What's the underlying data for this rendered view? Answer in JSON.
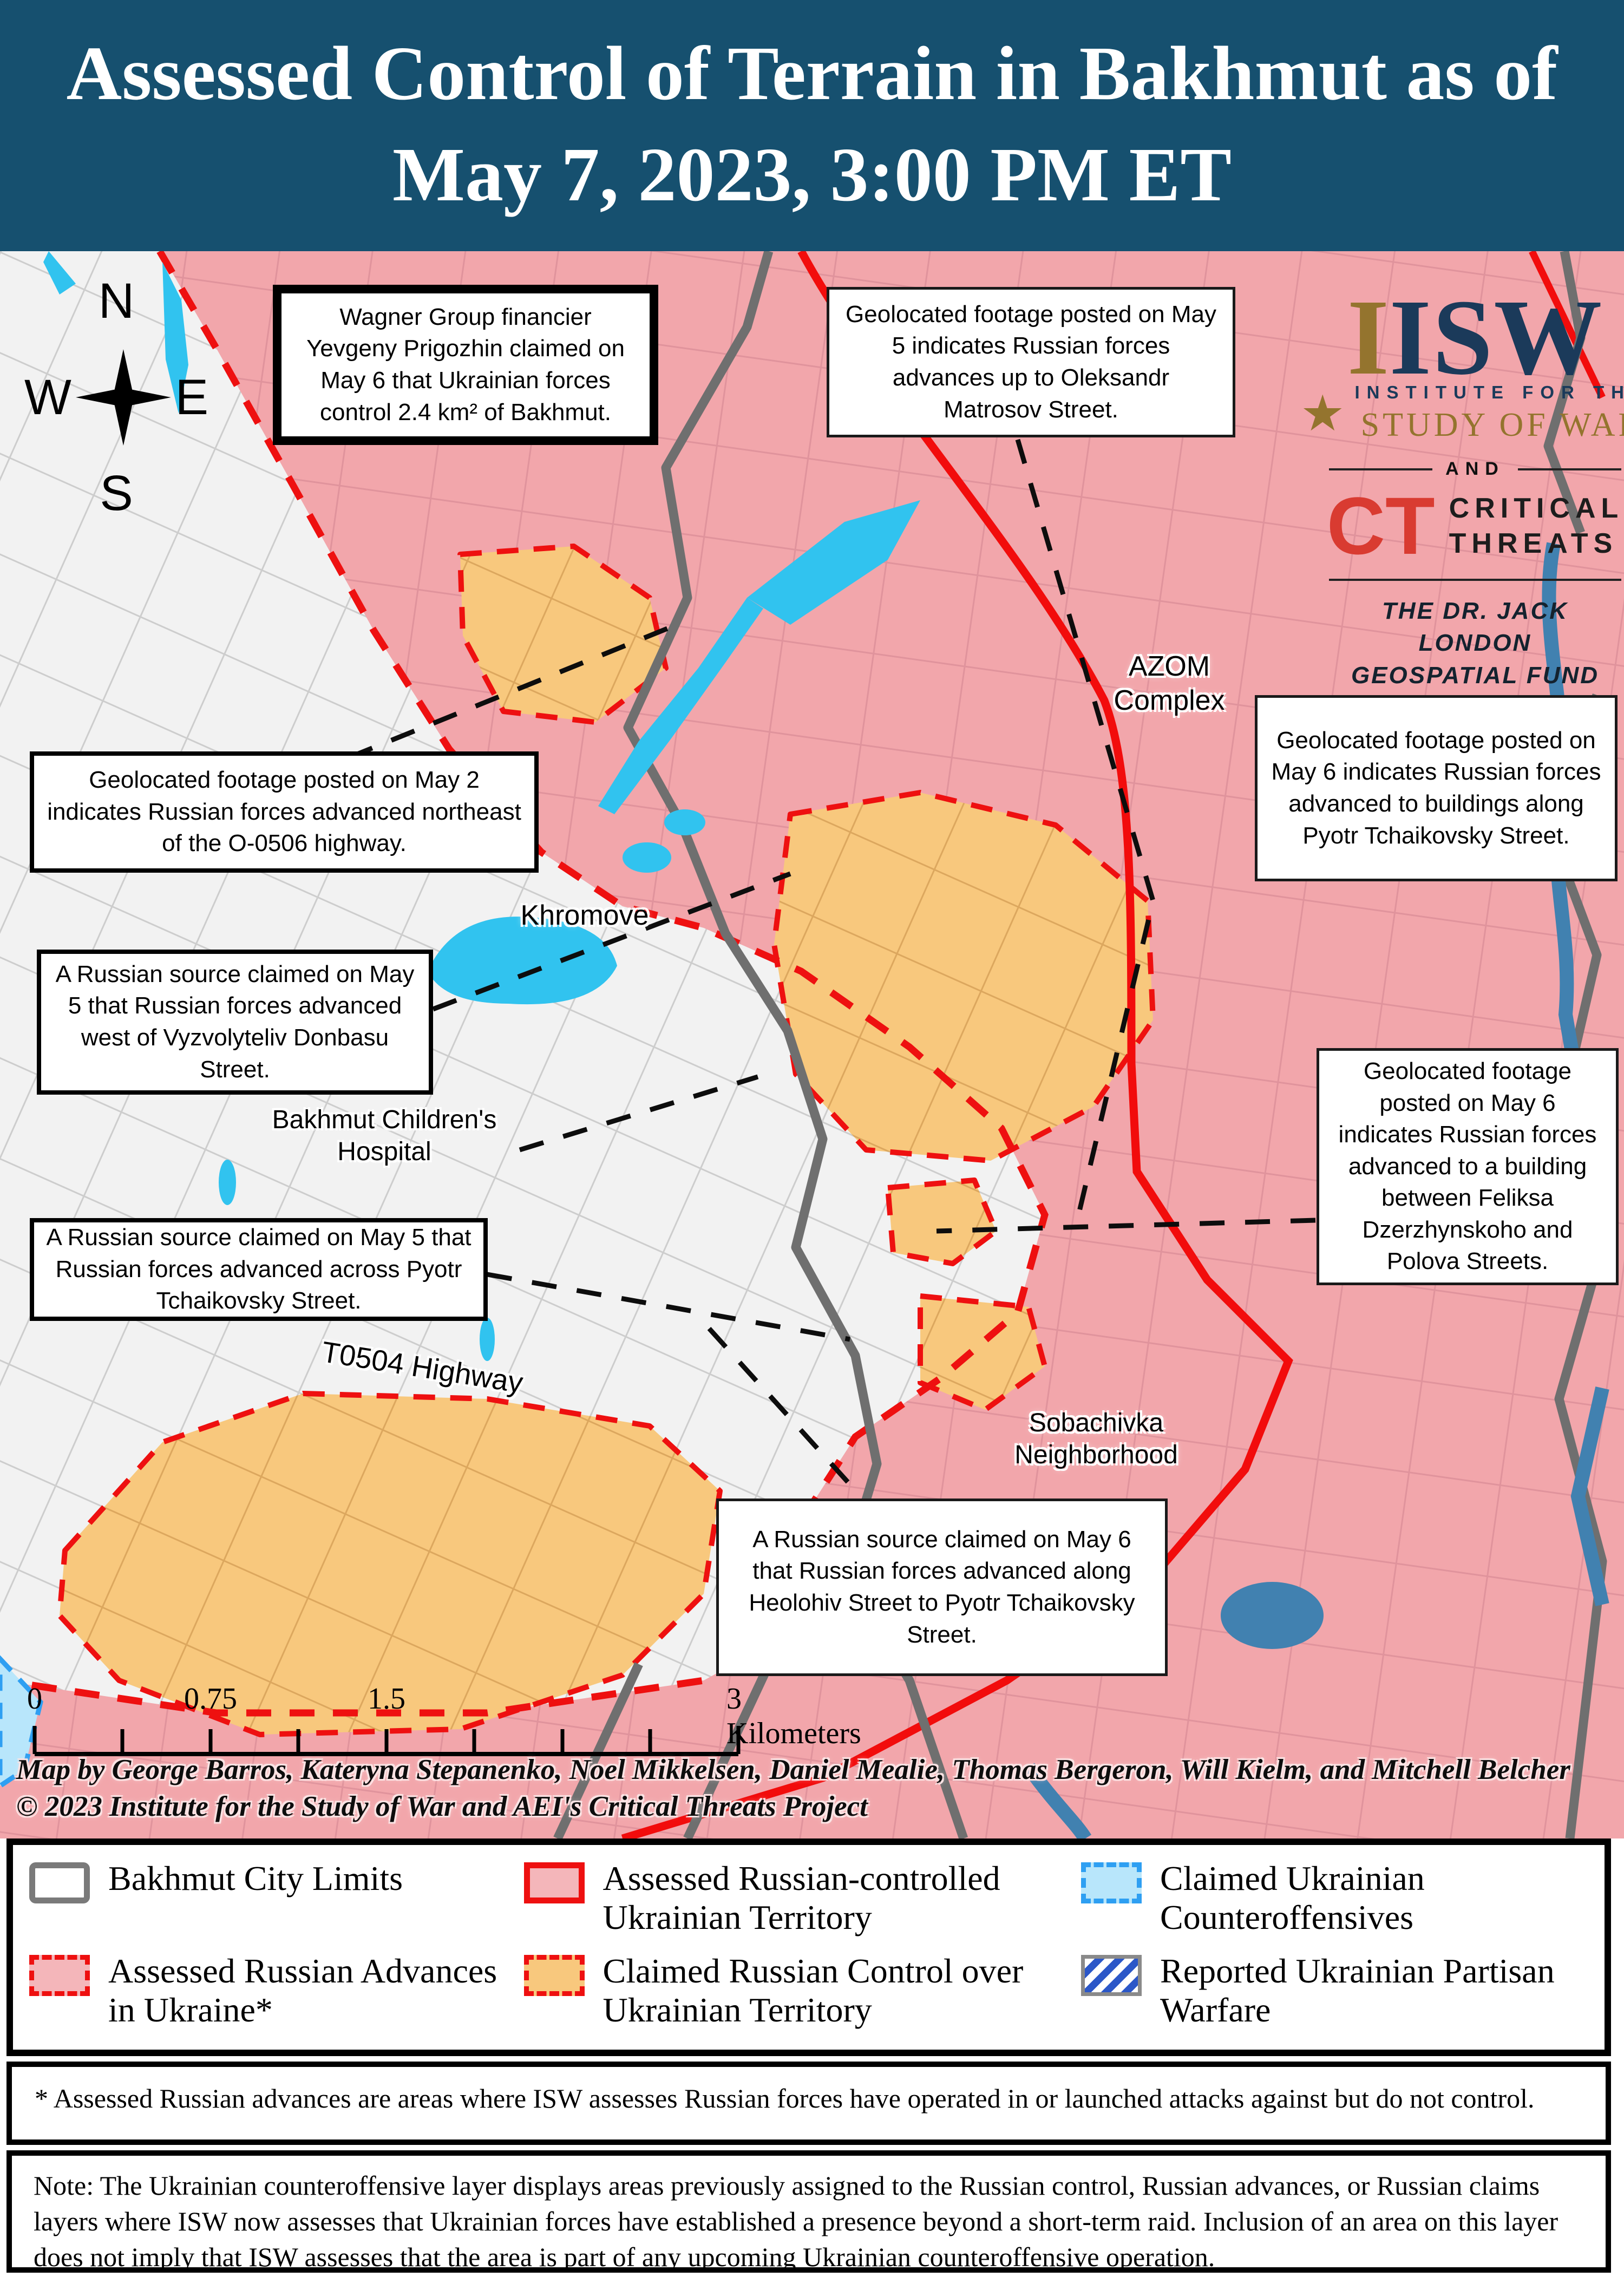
{
  "title": {
    "line1": "Assessed Control of Terrain in Bakhmut as of",
    "line2": "May 7, 2023, 3:00 PM ET"
  },
  "compass": {
    "north": "N",
    "east": "E",
    "south": "S",
    "west": "W"
  },
  "logo": {
    "gold_i": "I",
    "isw": "ISW",
    "star_icon": "★",
    "institute": "INSTITUTE FOR THE",
    "study": "STUDY OF WAR",
    "and": "AND",
    "ct_mark": "CT",
    "critical": "CRITICAL",
    "threats": "THREATS",
    "fund": "THE DR. JACK LONDON\nGEOSPATIAL FUND"
  },
  "callouts": [
    {
      "id": "wagner",
      "text": "Wagner Group financier Yevgeny Prigozhin claimed on May 6 that Ukrainian forces control 2.4 km² of Bakhmut."
    },
    {
      "id": "matrosov",
      "text": "Geolocated footage posted on May 5 indicates Russian forces advances up to Oleksandr Matrosov Street."
    },
    {
      "id": "tchaikovsky-buildings",
      "text": "Geolocated footage posted on May 6 indicates Russian forces advanced to buildings along Pyotr Tchaikovsky Street."
    },
    {
      "id": "may2-highway",
      "text": "Geolocated footage posted on May 2 indicates Russian forces advanced northeast of the O-0506 highway."
    },
    {
      "id": "vyzvolyteliv",
      "text": "A Russian source claimed on May 5 that Russian forces advanced west of Vyzvolyteliv Donbasu Street."
    },
    {
      "id": "across-tchaikovsky",
      "text": "A Russian source claimed on May 5 that Russian forces advanced across Pyotr Tchaikovsky Street."
    },
    {
      "id": "feliksa-polova",
      "text": "Geolocated footage posted on May 6 indicates Russian forces advanced to a building between Feliksa Dzerzhynskoho and Polova Streets."
    },
    {
      "id": "heolohiv",
      "text": "A Russian source claimed on May 6 that Russian forces advanced along Heolohiv Street to Pyotr Tchaikovsky Street."
    }
  ],
  "map_labels": {
    "khromove": "Khromove",
    "azom": "AZOM\nComplex",
    "hospital": "Bakhmut Children's\nHospital",
    "t0504": "T0504 Highway",
    "sobachivka": "Sobachivka\nNeighborhood"
  },
  "scalebar": {
    "zero": "0",
    "threequarter": "0.75",
    "onefive": "1.5",
    "three": "3 Kilometers"
  },
  "credits": {
    "line1": "Map by George Barros, Kateryna Stepanenko, Noel Mikkelsen, Daniel Mealie, Thomas Bergeron, Will Kielm, and Mitchell Belcher",
    "line2": "© 2023 Institute for the Study of War and AEI's Critical Threats Project"
  },
  "legend": {
    "items": [
      {
        "key": "city-limits",
        "label": "Bakhmut City Limits"
      },
      {
        "key": "russian-advances",
        "label": "Assessed Russian Advances in Ukraine*"
      },
      {
        "key": "russian-controlled",
        "label": "Assessed Russian-controlled Ukrainian Territory"
      },
      {
        "key": "claimed-russian",
        "label": "Claimed Russian Control over Ukrainian Territory"
      },
      {
        "key": "ukrainian-counteroffensives",
        "label": "Claimed Ukrainian Counteroffensives"
      },
      {
        "key": "partisan-warfare",
        "label": "Reported Ukrainian Partisan Warfare"
      }
    ]
  },
  "footnote": "* Assessed Russian advances are areas where ISW assesses Russian forces have operated in or launched attacks against but do not control.",
  "note": "Note: The Ukrainian counteroffensive layer displays areas previously assigned to the Russian control, Russian advances, or Russian claims layers where ISW now assesses that Ukrainian forces have established a presence beyond a short-term raid. Inclusion of an area on this layer does not imply that ISW assesses that the area is part of any upcoming Ukrainian counteroffensive operation.",
  "colors": {
    "title_bg": "#16506f",
    "russian_controlled_fill": "#f2a6ab",
    "claimed_russian_fill": "#f8c87d",
    "advance_fill": "#f4b6ba",
    "front_red": "#ee1010",
    "counteroffensive_fill": "#b8e6fb",
    "counteroffensive_border": "#2e9ff2",
    "partisan_blue": "#2b57c8",
    "water_cyan": "#31c3ef",
    "water_blue": "#4181b0",
    "city_limits_gray": "#6f6f6f",
    "isw_navy": "#1b3a5a",
    "isw_gold": "#94742e",
    "ct_red": "#d93b31"
  }
}
